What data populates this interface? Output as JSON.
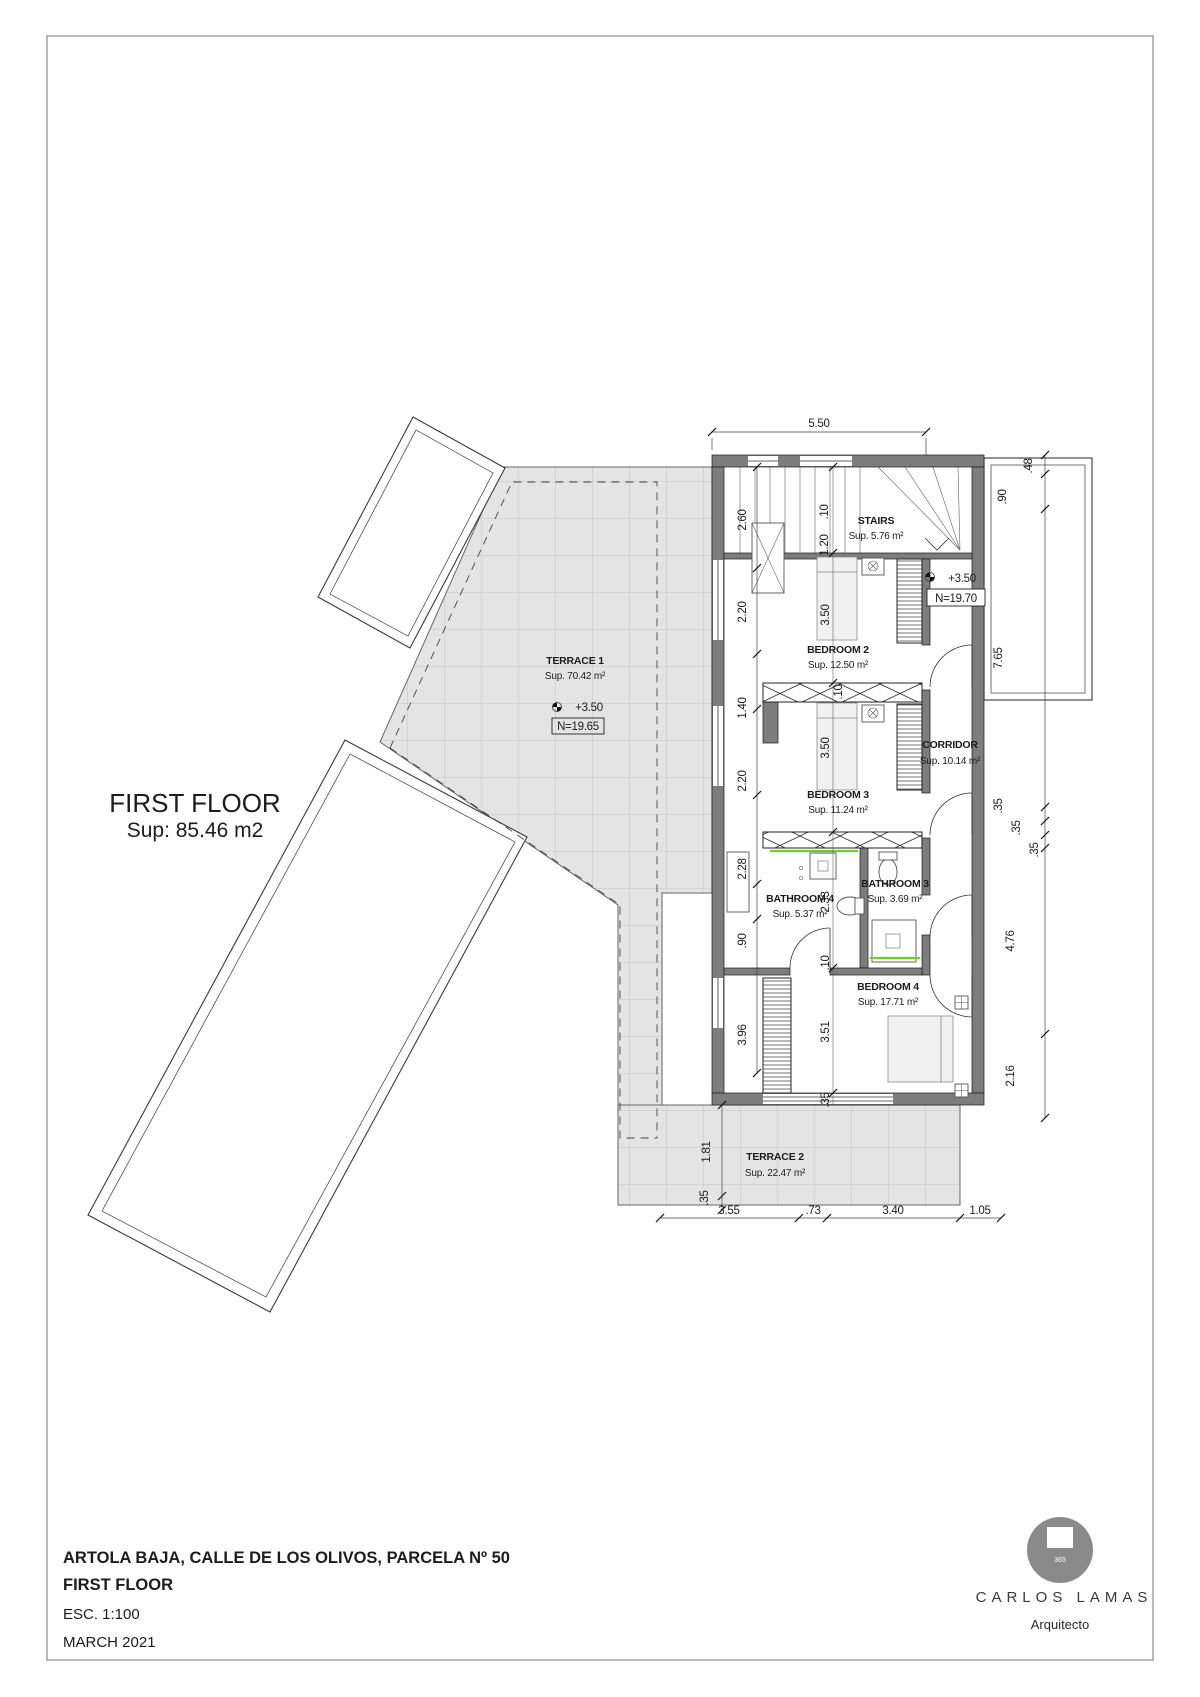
{
  "plan": {
    "floor_title": "FIRST FLOOR",
    "floor_area": "Sup: 85.46 m2",
    "rooms": {
      "stairs": {
        "name": "STAIRS",
        "area": "Sup. 5.76 m²"
      },
      "bedroom2": {
        "name": "BEDROOM 2",
        "area": "Sup. 12.50 m²"
      },
      "bedroom3": {
        "name": "BEDROOM 3",
        "area": "Sup. 11.24 m²"
      },
      "bedroom4": {
        "name": "BEDROOM 4",
        "area": "Sup. 17.71 m²"
      },
      "bathroom4": {
        "name": "BATHROOM 4",
        "area": "Sup. 5.37 m²"
      },
      "bathroom3": {
        "name": "BATHROOM 3",
        "area": "Sup. 3.69 m²"
      },
      "corridor": {
        "name": "CORRIDOR",
        "area": "Sup. 10.14 m²"
      },
      "terrace1": {
        "name": "TERRACE 1",
        "area": "Sup. 70.42 m²"
      },
      "terrace2": {
        "name": "TERRACE 2",
        "area": "Sup. 22.47 m²"
      }
    },
    "levels": {
      "stairs_value": "+3.50",
      "stairs_datum": "N=19.70",
      "terrace_value": "+3.50",
      "terrace_datum": "N=19.65"
    },
    "dims": {
      "top": "5.50",
      "left": [
        "2.60",
        "2.20",
        "1.40",
        "2.20",
        "2.28",
        ".90",
        "3.96",
        "1.81",
        ".35"
      ],
      "right": [
        ".48",
        ".90",
        "7.65",
        ".35",
        ".35",
        ".35",
        "4.76",
        "2.16"
      ],
      "bottom": [
        "3.55",
        ".73",
        "3.40",
        "1.05"
      ],
      "inner": [
        ".10",
        "1.20",
        "3.50",
        ".10",
        "3.50",
        "2.33",
        ".10",
        "3.51",
        ".35"
      ]
    }
  },
  "title_block": {
    "address": "ARTOLA BAJA, CALLE DE LOS OLIVOS, PARCELA Nº 50",
    "floor": "FIRST FLOOR",
    "scale": "ESC. 1:100",
    "date": "MARCH  2021"
  },
  "logo": {
    "number": "365",
    "name": "CARLOS LAMAS",
    "subtitle": "Arquitecto"
  },
  "colors": {
    "wall": "#7d7d7d",
    "terrace_fill": "#e4e4e4",
    "accent_green": "#6fce2e"
  }
}
